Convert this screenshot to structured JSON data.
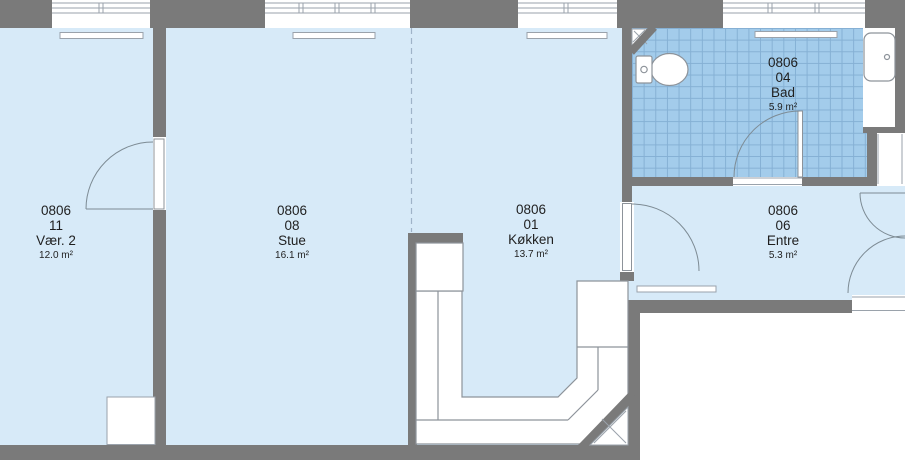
{
  "plan": {
    "title": "Floor plan unit 0806",
    "rooms": [
      {
        "unit": "0806",
        "id": "11",
        "name": "Vær. 2",
        "area": "12.0 m²"
      },
      {
        "unit": "0806",
        "id": "08",
        "name": "Stue",
        "area": "16.1 m²"
      },
      {
        "unit": "0806",
        "id": "01",
        "name": "Køkken",
        "area": "13.7 m²"
      },
      {
        "unit": "0806",
        "id": "04",
        "name": "Bad",
        "area": "5.9 m²"
      },
      {
        "unit": "0806",
        "id": "06",
        "name": "Entre",
        "area": "5.3 m²"
      }
    ],
    "fixtures": [
      "toilet-icon",
      "bathtub-icon"
    ],
    "colors": {
      "room_fill": "#d7eaf8",
      "tile_fill": "#a3cceb",
      "tile_grid": "#85b0d4",
      "wall": "#7a7a7a",
      "outline": "#8d939a",
      "window_line": "#9aa2ab",
      "text": "#1f1f1f"
    }
  }
}
